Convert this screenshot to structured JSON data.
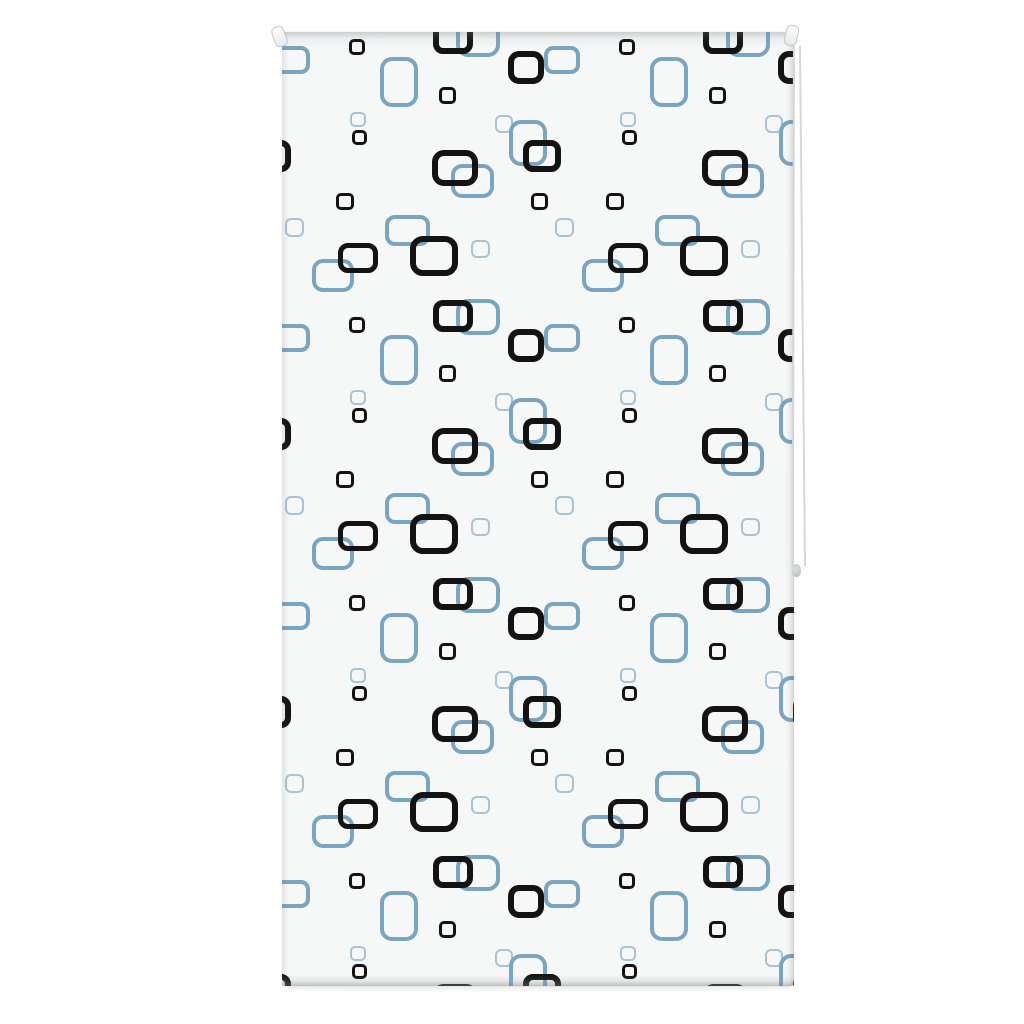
{
  "scene": {
    "description": "Product photo of a white roller blind with a retro pattern of black and steel-blue rounded squares, with side pull cord",
    "background_color": "#ffffff"
  },
  "blind": {
    "x": 282,
    "y": 32,
    "width": 512,
    "height": 954,
    "fabric_color": "#f6f7f7",
    "pattern": {
      "tile_width": 270,
      "tile_height": 278,
      "origin_offset_x": 0,
      "origin_offset_y": 8,
      "rows_from": -1,
      "rows_to": 3,
      "cols_from": -1,
      "cols_to": 1,
      "colors": {
        "black": "#131313",
        "blue": "#7AA5C2",
        "pale": "#A9C3D2"
      },
      "elements": [
        {
          "c": "blue",
          "x": 10,
          "y": 20,
          "w": 36,
          "h": 28,
          "bw": 4
        },
        {
          "c": "blue",
          "x": 196,
          "y": 277,
          "w": 44,
          "h": 36,
          "bw": 4.5
        },
        {
          "c": "blue",
          "x": 117,
          "y": 42,
          "w": 38,
          "h": 50,
          "bw": 4.5
        },
        {
          "c": "pale",
          "x": 222,
          "y": 84,
          "w": 18,
          "h": 18,
          "bw": 2.5
        },
        {
          "c": "blue",
          "x": 246,
          "y": 103,
          "w": 38,
          "h": 46,
          "bw": 4.5
        },
        {
          "c": "pale",
          "x": 76,
          "y": 79,
          "w": 16,
          "h": 15,
          "bw": 2.5
        },
        {
          "c": "blue",
          "x": 190,
          "y": 141,
          "w": 43,
          "h": 34,
          "bw": 4.5
        },
        {
          "c": "pale",
          "x": 12,
          "y": 187,
          "w": 19,
          "h": 19,
          "bw": 2.5
        },
        {
          "c": "blue",
          "x": 125,
          "y": 190,
          "w": 45,
          "h": 31,
          "bw": 4.5
        },
        {
          "c": "pale",
          "x": 198,
          "y": 209,
          "w": 19,
          "h": 18,
          "bw": 2.5
        },
        {
          "c": "blue",
          "x": 51,
          "y": 235,
          "w": 42,
          "h": 33,
          "bw": 4.5
        },
        {
          "c": "black",
          "x": 244,
          "y": 27,
          "w": 36,
          "h": 33,
          "bw": 6
        },
        {
          "c": "black",
          "x": 75,
          "y": 7,
          "w": 16,
          "h": 16,
          "bw": 3
        },
        {
          "c": "black",
          "x": 171,
          "y": 276,
          "w": 40,
          "h": 32,
          "bw": 6
        },
        {
          "c": "black",
          "x": 165,
          "y": 55,
          "w": 17,
          "h": 17,
          "bw": 3
        },
        {
          "c": "black",
          "x": 77,
          "y": 97,
          "w": 15,
          "h": 15,
          "bw": 3
        },
        {
          "c": "black",
          "x": 173,
          "y": 128,
          "w": 46,
          "h": 36,
          "bw": 6
        },
        {
          "c": "black",
          "x": 260,
          "y": 116,
          "w": 38,
          "h": 32,
          "bw": 6
        },
        {
          "c": "black",
          "x": 63,
          "y": 161,
          "w": 18,
          "h": 17,
          "bw": 3
        },
        {
          "c": "black",
          "x": 257,
          "y": 161,
          "w": 17,
          "h": 17,
          "bw": 3
        },
        {
          "c": "black",
          "x": 76,
          "y": 218,
          "w": 40,
          "h": 30,
          "bw": 5.5
        },
        {
          "c": "black",
          "x": 152,
          "y": 216,
          "w": 48,
          "h": 40,
          "bw": 6.5
        }
      ]
    },
    "bottom_shadow": {
      "x": 287,
      "y": 984,
      "width": 503,
      "height": 9
    }
  },
  "roller": {
    "left_pin": {
      "x": 273,
      "y": 26,
      "width": 13,
      "height": 21
    },
    "right_pin": {
      "x": 785,
      "y": 25,
      "width": 13,
      "height": 21
    },
    "pin_color": "#f2f3f3",
    "pin_border_color": "#c3c7c9"
  },
  "cord": {
    "x": 792.5,
    "x2": 799,
    "y_top": 46,
    "y_bottom": 566,
    "line_color": "#d5d7d8",
    "bead": {
      "x": 792,
      "y": 564,
      "width": 9,
      "height": 13,
      "color": "#c0c3c5"
    }
  }
}
